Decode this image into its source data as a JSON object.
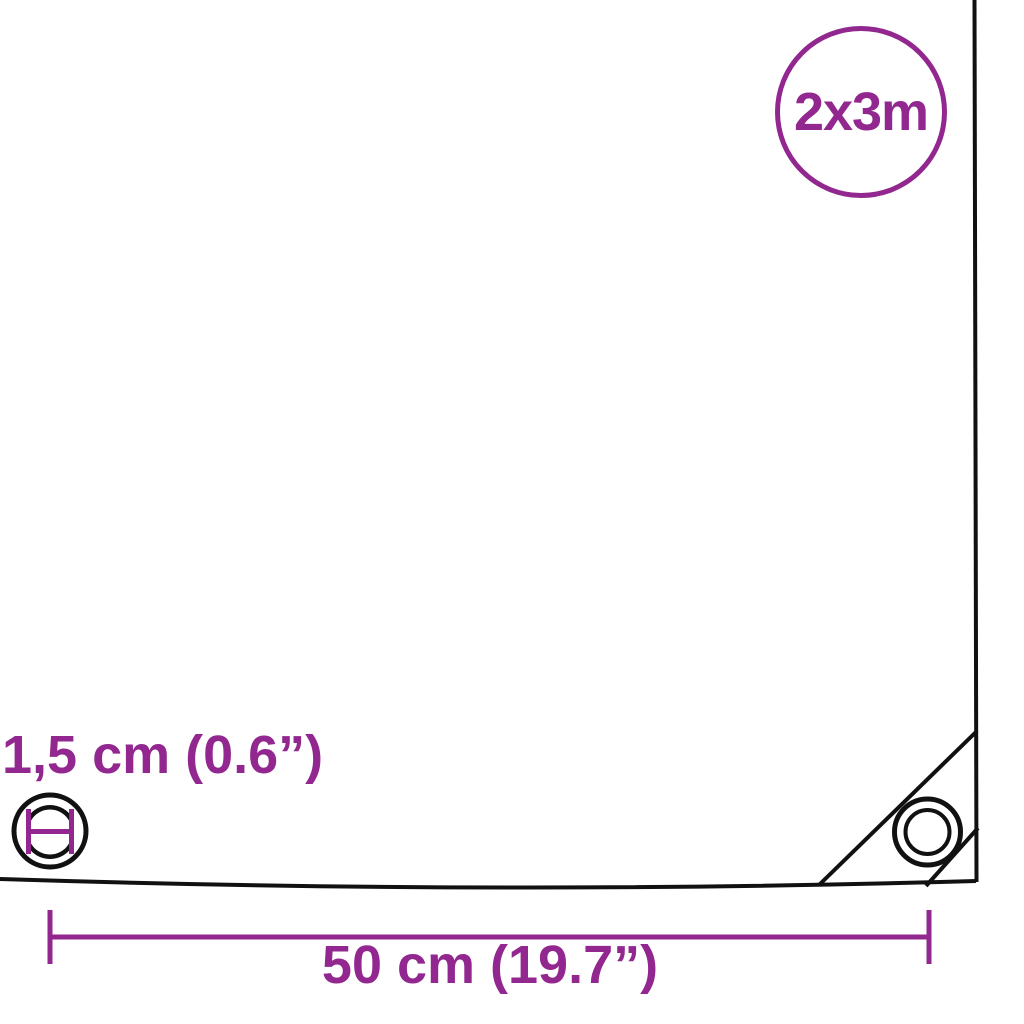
{
  "diagram": {
    "type": "product-dimension-diagram",
    "size_badge": {
      "label": "2x3m"
    },
    "grommet_diameter_label": "1,5 cm (0.6”)",
    "grommet_spacing_label": "50 cm (19.7”)",
    "colors": {
      "accent": "#92278F",
      "line": "#111111",
      "background": "#FFFFFF"
    },
    "icons": [
      {
        "name": "size-badge-circle",
        "meaning": "tarp size 2x3m"
      },
      {
        "name": "grommet-diameter-icon",
        "meaning": "eyelet inner diameter measured"
      },
      {
        "name": "corner-grommet-icon",
        "meaning": "reinforced corner eyelet"
      }
    ]
  }
}
